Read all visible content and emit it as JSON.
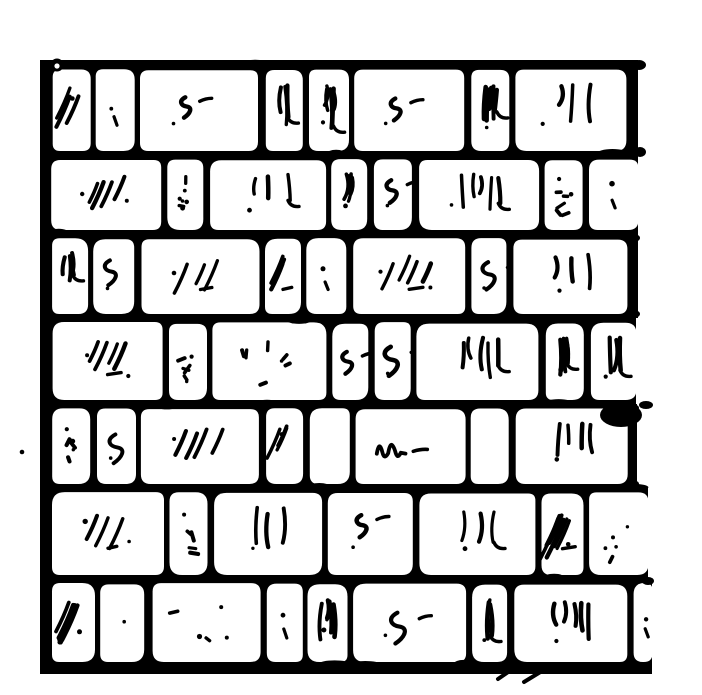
{
  "figure": {
    "subject": "Hand-drawn pen-and-ink engraving of a brick wall: seven courses of rounded bricks with thick irregular black mortar joints, solid border on top and left, ragged open right edge",
    "style": "woodcut-engraving",
    "ink": "#000000",
    "paper": "#ffffff"
  },
  "canvas": {
    "width": 702,
    "height": 695
  },
  "wall": {
    "left": 40,
    "left_bar": 12,
    "top": 60,
    "bottom": 674,
    "top_line": 10,
    "joint": 9,
    "bottom_line": 12,
    "brick_corner_radius": 10,
    "row_tops": [
      60,
      155,
      234,
      318,
      404,
      488,
      579
    ],
    "rows": [
      {
        "right": 638,
        "open_right": false,
        "bricks": [
          [
            52,
            38,
            "hatch"
          ],
          [
            96,
            39,
            "sparse"
          ],
          [
            141,
            118,
            "squiggle"
          ],
          [
            266,
            37,
            "verticals"
          ],
          [
            309,
            40,
            "verticals"
          ],
          [
            355,
            110,
            "squiggle"
          ],
          [
            471,
            38,
            "verticals"
          ],
          [
            516,
            111,
            "verticals"
          ]
        ]
      },
      {
        "right": 638,
        "open_right": true,
        "bricks": [
          [
            52,
            110,
            "hatch"
          ],
          [
            168,
            36,
            "dots"
          ],
          [
            210,
            116,
            "verticals"
          ],
          [
            332,
            36,
            "verticals"
          ],
          [
            374,
            38,
            "squiggle"
          ],
          [
            419,
            120,
            "verticals"
          ],
          [
            545,
            38,
            "dots"
          ],
          [
            590,
            48,
            "sparse"
          ]
        ]
      },
      {
        "right": 638,
        "open_right": false,
        "bricks": [
          [
            52,
            36,
            "verticals"
          ],
          [
            94,
            41,
            "squiggle"
          ],
          [
            141,
            118,
            "hatch"
          ],
          [
            265,
            36,
            "hatch"
          ],
          [
            307,
            40,
            "sparse"
          ],
          [
            353,
            112,
            "hatch"
          ],
          [
            472,
            35,
            "squiggle"
          ],
          [
            513,
            114,
            "verticals"
          ]
        ]
      },
      {
        "right": 636,
        "open_right": true,
        "bricks": [
          [
            52,
            110,
            "hatch"
          ],
          [
            168,
            38,
            "dots"
          ],
          [
            212,
            114,
            "dots"
          ],
          [
            332,
            36,
            "squiggle"
          ],
          [
            374,
            36,
            "squiggle"
          ],
          [
            417,
            122,
            "verticals"
          ],
          [
            545,
            38,
            "verticals"
          ],
          [
            590,
            46,
            "verticals"
          ]
        ]
      },
      {
        "right": 637,
        "open_right": false,
        "bricks": [
          [
            52,
            38,
            "dots"
          ],
          [
            96,
            39,
            "squiggle"
          ],
          [
            141,
            118,
            "hatch"
          ],
          [
            266,
            37,
            "hatch"
          ],
          [
            309,
            40,
            "blank"
          ],
          [
            355,
            110,
            "scribble"
          ],
          [
            471,
            38,
            "blank"
          ],
          [
            515,
            112,
            "verticals"
          ]
        ]
      },
      {
        "right": 648,
        "open_right": true,
        "bricks": [
          [
            52,
            112,
            "hatch"
          ],
          [
            170,
            38,
            "dots"
          ],
          [
            214,
            108,
            "verticals"
          ],
          [
            328,
            85,
            "squiggle"
          ],
          [
            419,
            116,
            "verticals"
          ],
          [
            541,
            42,
            "hatch-heavy"
          ],
          [
            590,
            58,
            "dots"
          ]
        ]
      },
      {
        "right": 652,
        "open_right": true,
        "bricks": [
          [
            52,
            43,
            "hatch-heavy"
          ],
          [
            101,
            44,
            "sparse"
          ],
          [
            152,
            108,
            "dots"
          ],
          [
            266,
            36,
            "sparse"
          ],
          [
            308,
            40,
            "verticals"
          ],
          [
            354,
            113,
            "squiggle"
          ],
          [
            473,
            35,
            "verticals"
          ],
          [
            514,
            113,
            "verticals"
          ],
          [
            634,
            18,
            "sparse"
          ]
        ]
      }
    ]
  },
  "accents": {
    "stray_dot": {
      "cx": 22,
      "cy": 452,
      "r": 2.3
    },
    "blob": {
      "cx": 621,
      "cy": 415,
      "rx": 21,
      "ry": 12
    },
    "knob": {
      "cx": 57,
      "cy": 65,
      "r": 6.5,
      "hole": 2.6
    },
    "nubs": [
      {
        "cx": 639,
        "cy": 65,
        "rx": 7,
        "ry": 5
      },
      {
        "cx": 640,
        "cy": 152,
        "rx": 6,
        "ry": 5
      },
      {
        "cx": 646,
        "cy": 405,
        "rx": 7,
        "ry": 4
      },
      {
        "cx": 648,
        "cy": 581,
        "rx": 6,
        "ry": 4
      }
    ],
    "bottom_ticks": [
      [
        498,
        679,
        511,
        670
      ],
      [
        524,
        682,
        542,
        671
      ]
    ]
  }
}
